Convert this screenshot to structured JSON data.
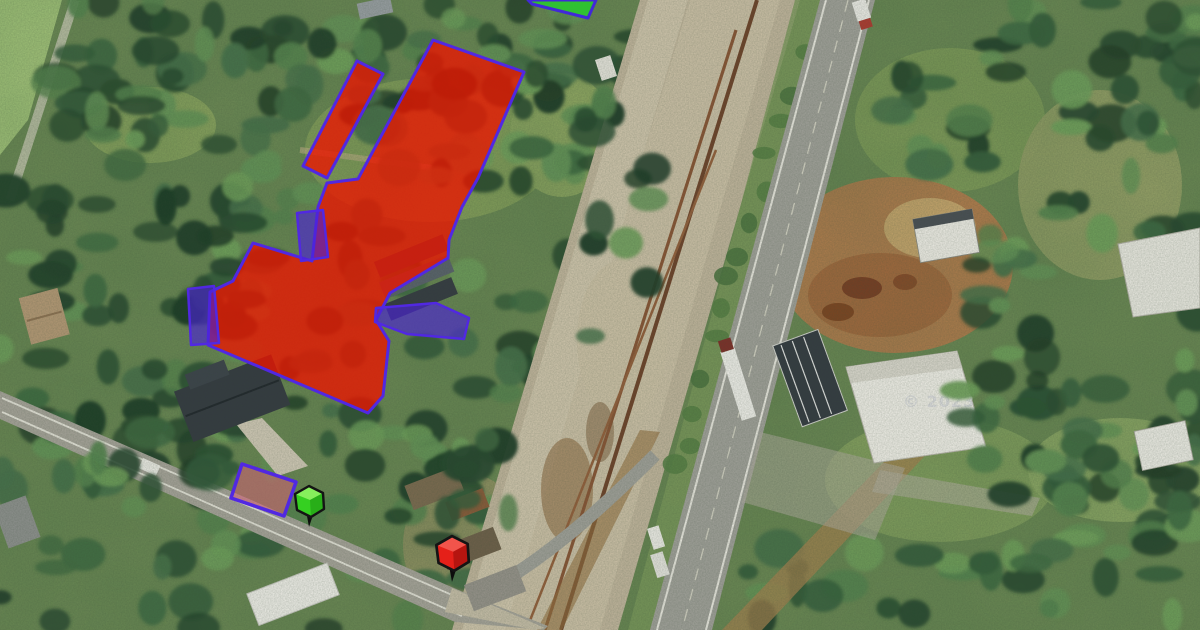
{
  "map": {
    "description": "Aerial parcel map with highlighted land boundaries and location pins",
    "watermark": {
      "text": "© 2023",
      "color": "#d9dade",
      "opacity": 0.8
    },
    "overlay": {
      "polygons": [
        {
          "name": "parcel-red-main",
          "fill": "#ec1500",
          "fill_opacity": 0.78,
          "stroke": "#5128e2",
          "stroke_width": 3,
          "points": "433,40 524,72 478,178 462,207 449,240 448,258 390,293 376,320 389,341 383,396 368,413 208,345 210,292 233,281 253,243 312,261 318,207 327,183 358,179"
        },
        {
          "name": "parcel-red-strip",
          "fill": "#ec1500",
          "fill_opacity": 0.78,
          "stroke": "#5128e2",
          "stroke_width": 3,
          "points": "357,61 383,74 327,178 303,166"
        },
        {
          "name": "parcel-green-top",
          "fill": "#2bc82f",
          "fill_opacity": 0.9,
          "stroke": "#4128d8",
          "stroke_width": 3,
          "points": "528,0 596,0 588,18 532,4"
        },
        {
          "name": "parcel-purple-small",
          "fill": "#4a22d8",
          "fill_opacity": 0.62,
          "stroke": "#5128e2",
          "stroke_width": 2.5,
          "points": "297,213 323,210 328,257 301,261"
        },
        {
          "name": "parcel-purple-left",
          "fill": "#4a22d8",
          "fill_opacity": 0.62,
          "stroke": "#5128e2",
          "stroke_width": 2.5,
          "points": "188,289 214,286 219,343 191,345"
        },
        {
          "name": "parcel-purple-right",
          "fill": "#4a22d8",
          "fill_opacity": 0.62,
          "stroke": "#5128e2",
          "stroke_width": 2.5,
          "points": "376,308 436,303 469,318 464,339 407,334 375,322"
        },
        {
          "name": "parcel-pink",
          "fill": "#e0607a",
          "fill_opacity": 0.5,
          "stroke": "#5128e2",
          "stroke_width": 3.5,
          "points": "242,464 296,482 284,516 231,498"
        }
      ],
      "markers": [
        {
          "name": "map-pin-green",
          "color": "#35d021",
          "top_color": "#8bf060",
          "side_color": "#1d9212",
          "tip_x": 309,
          "tip_y": 527,
          "scale": 1.0
        },
        {
          "name": "map-pin-red",
          "color": "#e52019",
          "top_color": "#f2574e",
          "side_color": "#8f0d0a",
          "tip_x": 452,
          "tip_y": 582,
          "scale": 1.12
        }
      ]
    }
  }
}
